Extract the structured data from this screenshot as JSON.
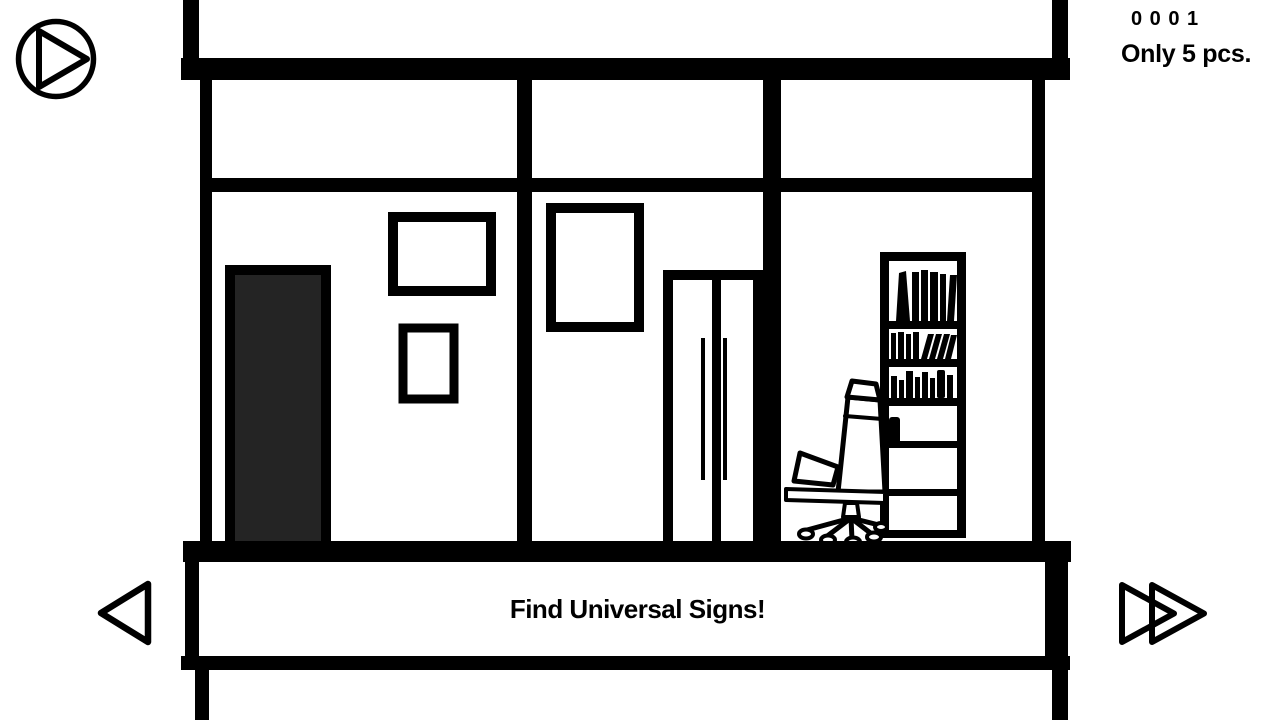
{
  "app": {
    "background_color": "#ffffff",
    "ink_color": "#000000"
  },
  "hud": {
    "counter": "0 0 0 1",
    "limit_label": "Only 5 pcs."
  },
  "banner": {
    "instruction": "Find Universal Signs!"
  },
  "nav": {
    "play_icon": "play-circle-icon",
    "back_icon": "previous-triangle-icon",
    "forward_icon": "fast-forward-double-triangle-icon"
  },
  "scene": {
    "style": "black-and-white line art room, three wall sections",
    "items": [
      "dark-door",
      "picture-frame-large",
      "picture-frame-small",
      "picture-frame-tall",
      "double-door-wardrobe",
      "bookshelf-with-books",
      "office-chair"
    ],
    "colors": {
      "line": "#000000",
      "door_fill": "#242424",
      "wall_fill": "#ffffff"
    }
  }
}
